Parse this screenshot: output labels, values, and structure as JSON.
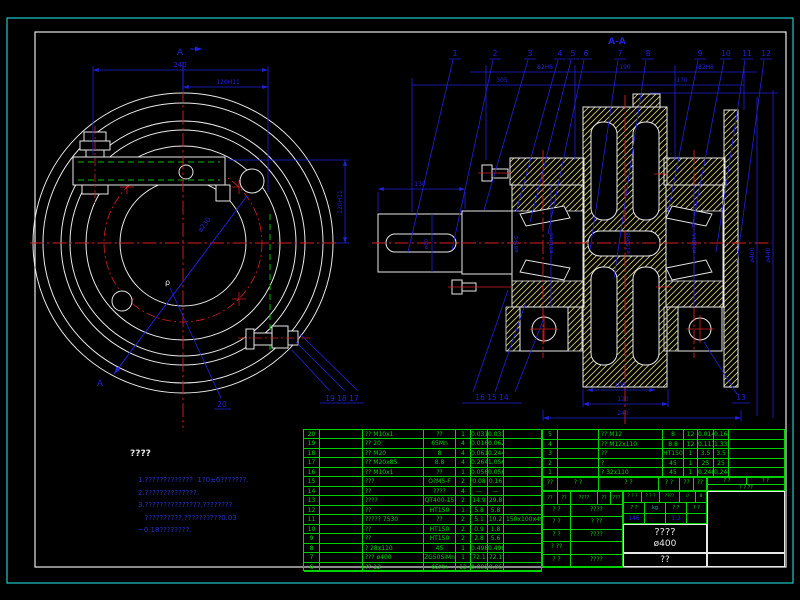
{
  "colors": {
    "frame_outer": "#1aacac",
    "frame_inner": "#e8e8e8",
    "dimension": "#2020dd",
    "centerline": "#d42020",
    "table": "#00d200",
    "hatch": "#cfc878",
    "notes": "#2233cc"
  },
  "left_view": {
    "section_label_top": "A",
    "section_label_bottom": "A",
    "dim_overall": "240",
    "dim_half": "120H11",
    "dim_side": "120H11",
    "dim_diag": "ø230",
    "label_p": "ρ",
    "leader_20": "20",
    "leader_19_18_17": "19 18 17"
  },
  "right_view": {
    "title": "A-A",
    "callouts": [
      "1",
      "2",
      "3",
      "4",
      "5",
      "6",
      "7",
      "8",
      "9",
      "10",
      "11",
      "12"
    ],
    "bottom_callouts": "16 15 14",
    "callout_13": "13",
    "dim_82_left": "82H8",
    "dim_190": "190",
    "dim_82_right": "82H8",
    "dim_305": "305",
    "dim_170": "170",
    "dim_130": "130",
    "dim_100": "100",
    "dim_120": "120",
    "dim_240": "240",
    "dia_labels": [
      "ø60",
      "ø85k6",
      "ø110k6",
      "ø180H8",
      "ø110k6"
    ],
    "dia_400": "ø400",
    "dia_440": "ø440"
  },
  "notes": {
    "heading": "????",
    "lines": [
      "1.?????????????  1?0±6???????.",
      "2.??????????????.",
      "3.???????????????,????????",
      "   ??????????,??????????0.03",
      "~0.18????????."
    ]
  },
  "bom": {
    "left_rows": [
      [
        "20",
        "",
        "?? M10x1",
        "??",
        "1",
        "0.031",
        "0.031",
        ""
      ],
      [
        "19",
        "",
        "?? 20",
        "65Mn",
        "4",
        "0.016",
        "0.062",
        ""
      ],
      [
        "18",
        "",
        "?? M20",
        "8",
        "4",
        "0.061",
        "0.244",
        ""
      ],
      [
        "17",
        "",
        "?? M20x85",
        "8.8",
        "4",
        "0.264",
        "1.056",
        ""
      ],
      [
        "16",
        "",
        "?? M10x1",
        "??",
        "1",
        "0.056",
        "0.056",
        ""
      ],
      [
        "15",
        "",
        "???",
        "O?M5-F",
        "2",
        "0.08",
        "0.16",
        ""
      ],
      [
        "14",
        "",
        "??",
        "????",
        "4",
        "—",
        "—",
        ""
      ],
      [
        "13",
        "",
        "????",
        "QT400-15",
        "2",
        "14.9",
        "29.8",
        ""
      ],
      [
        "12",
        "",
        "??",
        "HT150",
        "1",
        "5.8",
        "5.8",
        ""
      ],
      [
        "11",
        "",
        "????? 7530",
        "??",
        "2",
        "5.1",
        "10.2",
        "150x100x49.5"
      ],
      [
        "10",
        "",
        "??",
        "HT150",
        "2",
        "0.9",
        "1.8",
        ""
      ],
      [
        "9",
        "",
        "??",
        "HT150",
        "2",
        "2.8",
        "5.6",
        ""
      ],
      [
        "8",
        "",
        "? 28x110",
        "45",
        "1",
        "0.498",
        "0.498",
        ""
      ],
      [
        "7",
        "",
        "??? ø400",
        "ZG50SiMn",
        "1",
        "72.1",
        "72.1",
        ""
      ],
      [
        "6",
        "",
        "?? 12",
        "65Mn",
        "12",
        "0.005",
        "0.06",
        ""
      ]
    ],
    "right_rows": [
      [
        "5",
        "",
        "?? M12",
        "8",
        "12",
        "0.014",
        "0.168",
        ""
      ],
      [
        "4",
        "",
        "?? M12x110",
        "8.8",
        "12",
        "0.111",
        "1.332",
        ""
      ],
      [
        "3",
        "",
        "??",
        "HT150",
        "1",
        "3.5",
        "3.5",
        ""
      ],
      [
        "2",
        "",
        "?",
        "45",
        "1",
        "25",
        "25",
        ""
      ],
      [
        "1",
        "",
        "? 32x110",
        "45",
        "1",
        "0.248",
        "0.248",
        ""
      ]
    ],
    "header": [
      "??",
      "? ?",
      "? ?",
      "? ?",
      "??",
      "??"
    ],
    "header_right_top": [
      "? ?",
      "? ?"
    ],
    "header_right_bottom": "? ?  ??"
  },
  "title_block": {
    "row1": [
      "? ? ?",
      "? ? ?",
      "????",
      "//",
      "8"
    ],
    "row2": [
      "? ?",
      "kg",
      "? ?",
      "? ?"
    ],
    "row3": [
      "146",
      "",
      "1:2",
      ""
    ],
    "name_line1": "????",
    "name_line2": "ø400",
    "bottom": "??",
    "signature_header": [
      "??",
      "??",
      "????",
      "??",
      "???"
    ],
    "signature_rows": [
      [
        "? ?",
        "????"
      ],
      [
        "? ?",
        "? ??"
      ],
      [
        "? ?",
        "????"
      ],
      [
        "? ??",
        ""
      ],
      [
        "? ?",
        "????"
      ]
    ]
  }
}
